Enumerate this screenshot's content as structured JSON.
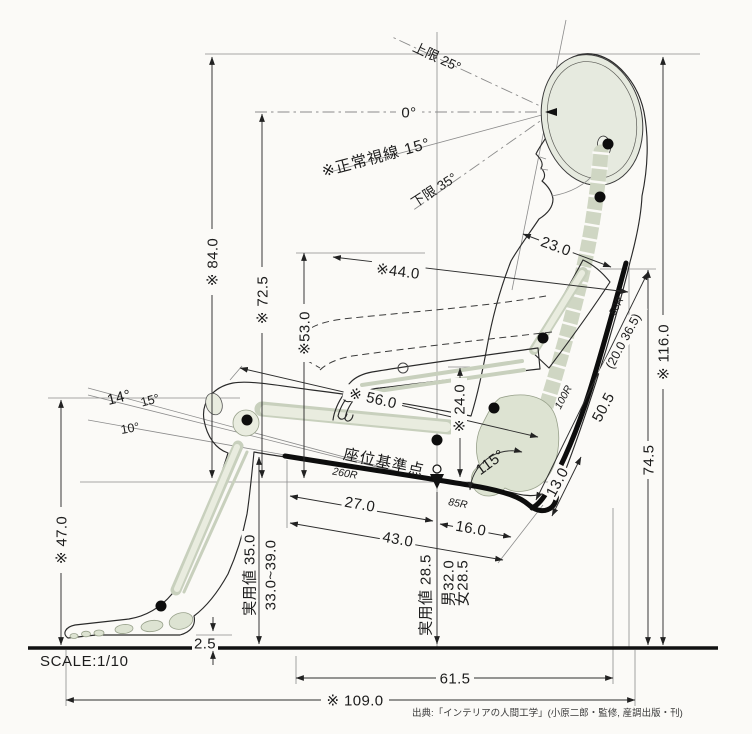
{
  "meta": {
    "scale": "SCALE:1/10",
    "source": "出典:「インテリアの人間工学」(小原二郎・監修, 産調出版・刊)"
  },
  "sight": {
    "upper": "上限 25°",
    "zero": "0°",
    "normal": "※正常視線 15°",
    "lower": "下限 35°"
  },
  "chair": {
    "seat_ref": "座位基準点",
    "back_angle": "115°",
    "r_seat_front": "260R",
    "r_seat_rear": "85R",
    "r_back_lower": "100R",
    "r_back_upper": "50R",
    "lumbar_range": "(20.0 36.5)"
  },
  "leg_angles": {
    "a14": "14°",
    "a15": "15°",
    "a10": "10°"
  },
  "dims": {
    "d84": "※ 84.0",
    "d72": "※ 72.5",
    "d53": "※53.0",
    "d47": "※ 47.0",
    "d56": "※ 56.0",
    "d44": "※44.0",
    "d23": "23.0",
    "d24": "※ 24.0",
    "d116": "※ 116.0",
    "d74": "74.5",
    "d50": "50.5",
    "d13": "13.0",
    "d16": "16.0",
    "d27": "27.0",
    "d43": "43.0",
    "d35": "実用値 35.0",
    "d33": "33.0~39.0",
    "d2_5": "2.5",
    "d28": "実用値 28.5",
    "d_male": "男32.0",
    "d_female": "女28.5",
    "d61": "61.5",
    "d109": "※ 109.0"
  }
}
